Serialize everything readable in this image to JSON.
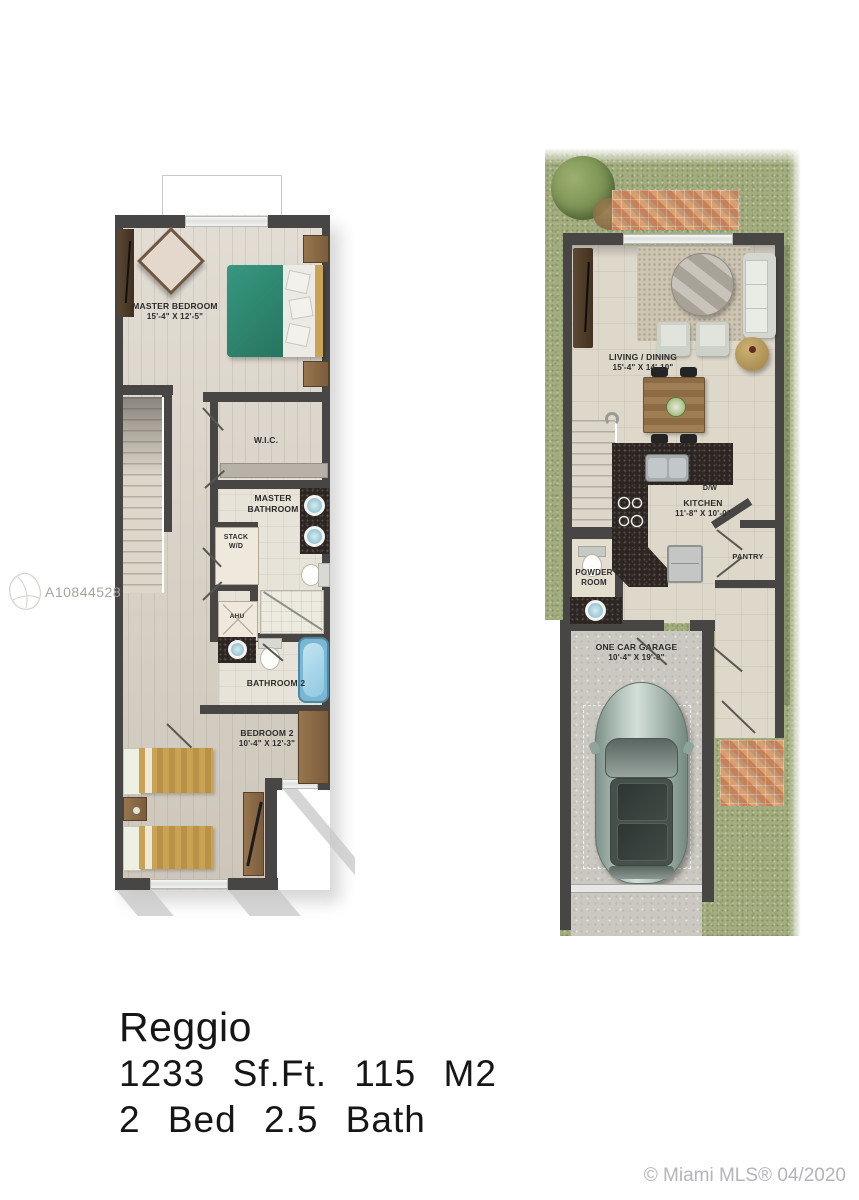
{
  "colors": {
    "wall": "#474644",
    "wood-floor": "#d9d2c6",
    "tile-floor": "#ded8cb",
    "grass": "#a3ad80",
    "brick": "#cf9668",
    "granite": "#2d2521",
    "concrete": "#cbc8c1",
    "master-bed-teal": "#2e8b74",
    "guest-bed-tan": "#c7a158",
    "bathtub-blue": "#79b7d4",
    "car-body": "#a9bdb3",
    "label-text": "#2b2b2b",
    "caption-text": "#161616",
    "watermark-gray": "#a9a49d",
    "copyright-gray": "#b4b4ba"
  },
  "floor2": {
    "rooms": {
      "master_bedroom": {
        "name": "MASTER BEDROOM",
        "dims": "15'-4\" X 12'-5\""
      },
      "wic": {
        "name": "W.I.C."
      },
      "master_bathroom": {
        "name": "MASTER BATHROOM"
      },
      "stack_wd": {
        "name": "STACK W/D"
      },
      "ahu": {
        "name": "AHU"
      },
      "bathroom_2": {
        "name": "BATHROOM 2"
      },
      "bedroom_2": {
        "name": "BEDROOM 2",
        "dims": "10'-4\" X 12'-3\""
      }
    }
  },
  "floor1": {
    "rooms": {
      "living_dining": {
        "name": "LIVING / DINING",
        "dims": "15'-4\" X 14'-10\""
      },
      "kitchen": {
        "name": "KITCHEN",
        "dims": "11'-8\" X 10'-0\""
      },
      "dishwasher": {
        "name": "D/W"
      },
      "pantry": {
        "name": "PANTRY"
      },
      "powder_room": {
        "name": "POWDER ROOM"
      },
      "garage": {
        "name": "ONE CAR GARAGE",
        "dims": "10'-4\" X 19'-0\""
      }
    }
  },
  "caption": {
    "model": "Reggio",
    "area": "1233 Sf.Ft. 115 M2",
    "beds_baths": "2 Bed 2.5 Bath"
  },
  "watermarks": {
    "listing_id": "A10844528",
    "copyright": "© Miami MLS® 04/2020"
  }
}
